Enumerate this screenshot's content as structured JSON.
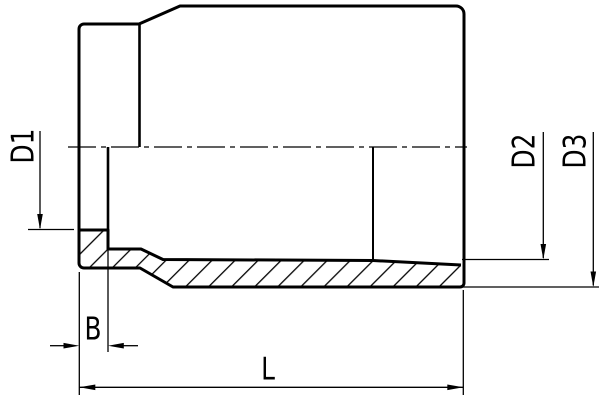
{
  "drawing": {
    "title": "pipe-socket-section-drawing",
    "colors": {
      "line": "#000000",
      "background": "#ffffff"
    },
    "dimensions": {
      "d1": {
        "label": "D1",
        "orientation": "vertical",
        "measures": "socket-bore-diameter"
      },
      "d2": {
        "label": "D2",
        "orientation": "vertical",
        "measures": "inner-bore-diameter"
      },
      "d3": {
        "label": "D3",
        "orientation": "vertical",
        "measures": "outer-diameter"
      },
      "b": {
        "label": "B",
        "orientation": "horizontal",
        "measures": "socket-depth"
      },
      "l": {
        "label": "L",
        "orientation": "horizontal",
        "measures": "overall-length"
      }
    }
  }
}
